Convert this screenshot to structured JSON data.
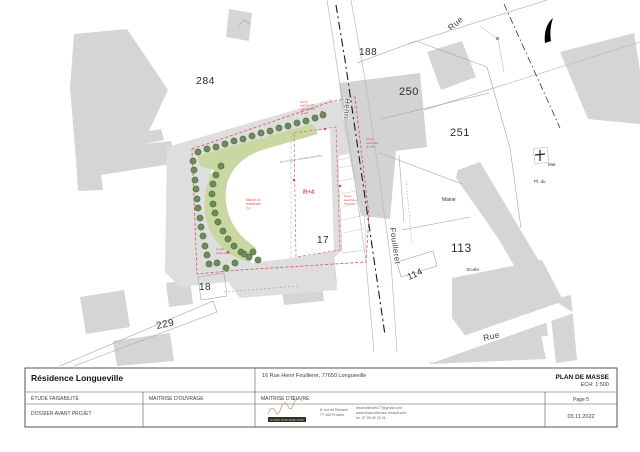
{
  "title_block": {
    "project": "Résidence Longueville",
    "address": "16 Rue Henri Fouilleret, 77650 Longueville",
    "doc_title": "PLAN DE MASSE",
    "scale": "ECH: 1:500",
    "phase": "ÉTUDE FAISABILITÉ",
    "owner_label": "MAITRISE D'OUVRAGE",
    "architect_label": "MAITRISE D'ŒUVRE",
    "page": "Page 5",
    "stage": "DOSSIER AVANT PROJET",
    "date": "03.11.2022",
    "logo_text": "STUDIO D'ARCHITECTURE",
    "contact": {
      "address_line1": "8, rue de Renault",
      "address_line2": "77 160 Provins",
      "email": "lesarchitectes77@gmail.com",
      "website": "www.lesarchitectes-renault.com",
      "phone": "tel. 07 59 42 23 41"
    }
  },
  "plan": {
    "colors": {
      "green_band": "#c9d8a3",
      "tree": "#6d8c58",
      "tree_stroke": "#4e683d",
      "red": "#d84f4f",
      "gray_building": "#d5d5d5"
    },
    "parcel_labels": [
      {
        "text": "284",
        "x": 196,
        "y": 84,
        "size": 10.5
      },
      {
        "text": "188",
        "x": 359,
        "y": 55,
        "size": 10
      },
      {
        "text": "250",
        "x": 399,
        "y": 95,
        "size": 11
      },
      {
        "text": "251",
        "x": 450,
        "y": 136,
        "size": 11
      },
      {
        "text": "113",
        "x": 451,
        "y": 252,
        "size": 12
      },
      {
        "text": "114",
        "x": 409,
        "y": 280,
        "size": 9,
        "rot": -25
      },
      {
        "text": "17",
        "x": 317,
        "y": 243,
        "size": 10
      },
      {
        "text": "18",
        "x": 199,
        "y": 290,
        "size": 10
      },
      {
        "text": "229",
        "x": 157,
        "y": 329,
        "size": 10,
        "rot": -12
      }
    ],
    "place_labels": [
      {
        "text": "Mairie",
        "x": 442,
        "y": 201,
        "size": 5
      },
      {
        "text": "Ecole",
        "x": 467,
        "y": 271,
        "size": 4.8
      },
      {
        "text": "Pl.  du",
        "x": 534,
        "y": 183,
        "size": 4.5
      },
      {
        "text": "Mar.",
        "x": 548,
        "y": 166,
        "size": 4.5
      }
    ],
    "street_labels": [
      {
        "text": "Rue",
        "x": 451,
        "y": 31,
        "size": 8.5,
        "rot": -40
      },
      {
        "text": "Henri",
        "x": 345,
        "y": 98,
        "size": 8,
        "rot": 93
      },
      {
        "text": "Fouilleret",
        "x": 390,
        "y": 228,
        "size": 8,
        "rot": 82
      },
      {
        "text": "Rue",
        "x": 484,
        "y": 341,
        "size": 8.5,
        "rot": -13
      }
    ],
    "building_label": {
      "text": "R+4",
      "x": 303,
      "y": 194,
      "size": 6
    },
    "micro_note": {
      "text": "mur et clôture existante conservés",
      "x": 280,
      "y": 163,
      "size": 2.8,
      "rot": -9
    },
    "annotations": [
      {
        "x": 300,
        "y": 103,
        "size": 3,
        "rot": -5,
        "lines": [
          "Accès",
          "piétons du",
          "site depuis",
          "la rue"
        ]
      },
      {
        "x": 366,
        "y": 140,
        "size": 3,
        "lines": [
          "Accès",
          "véhicules",
          "du site"
        ]
      },
      {
        "x": 344,
        "y": 197,
        "size": 3,
        "lines": [
          "Poste",
          "électrique",
          "proposé"
        ]
      },
      {
        "x": 246,
        "y": 201,
        "size": 3.2,
        "lines": [
          "Maison du",
          "restaurant",
          "2 p."
        ]
      },
      {
        "x": 216,
        "y": 250,
        "size": 3,
        "lines": [
          "Accès",
          "local vélos"
        ]
      }
    ],
    "trees": [
      [
        198,
        152
      ],
      [
        207,
        149
      ],
      [
        216,
        147
      ],
      [
        225,
        144
      ],
      [
        234,
        141
      ],
      [
        243,
        139
      ],
      [
        252,
        136
      ],
      [
        261,
        133
      ],
      [
        270,
        131
      ],
      [
        279,
        128
      ],
      [
        288,
        126
      ],
      [
        297,
        123
      ],
      [
        306,
        121
      ],
      [
        315,
        118
      ],
      [
        323,
        115
      ],
      [
        193,
        161
      ],
      [
        194,
        170
      ],
      [
        195,
        180
      ],
      [
        196,
        189
      ],
      [
        197,
        199
      ],
      [
        198,
        208
      ],
      [
        200,
        218
      ],
      [
        201,
        227
      ],
      [
        203,
        236
      ],
      [
        205,
        246
      ],
      [
        207,
        255
      ],
      [
        209,
        264
      ],
      [
        221,
        166
      ],
      [
        216,
        175
      ],
      [
        213,
        184
      ],
      [
        212,
        194
      ],
      [
        213,
        204
      ],
      [
        215,
        213
      ],
      [
        218,
        222
      ],
      [
        223,
        231
      ],
      [
        228,
        239
      ],
      [
        234,
        246
      ],
      [
        241,
        252
      ],
      [
        249,
        257
      ],
      [
        217,
        263
      ],
      [
        226,
        268
      ],
      [
        235,
        263
      ],
      [
        244,
        254
      ],
      [
        253,
        252
      ],
      [
        258,
        260
      ]
    ],
    "red_dots": [
      [
        322,
        112
      ],
      [
        325,
        129
      ],
      [
        340,
        186
      ],
      [
        294,
        180
      ],
      [
        228,
        252
      ]
    ]
  }
}
